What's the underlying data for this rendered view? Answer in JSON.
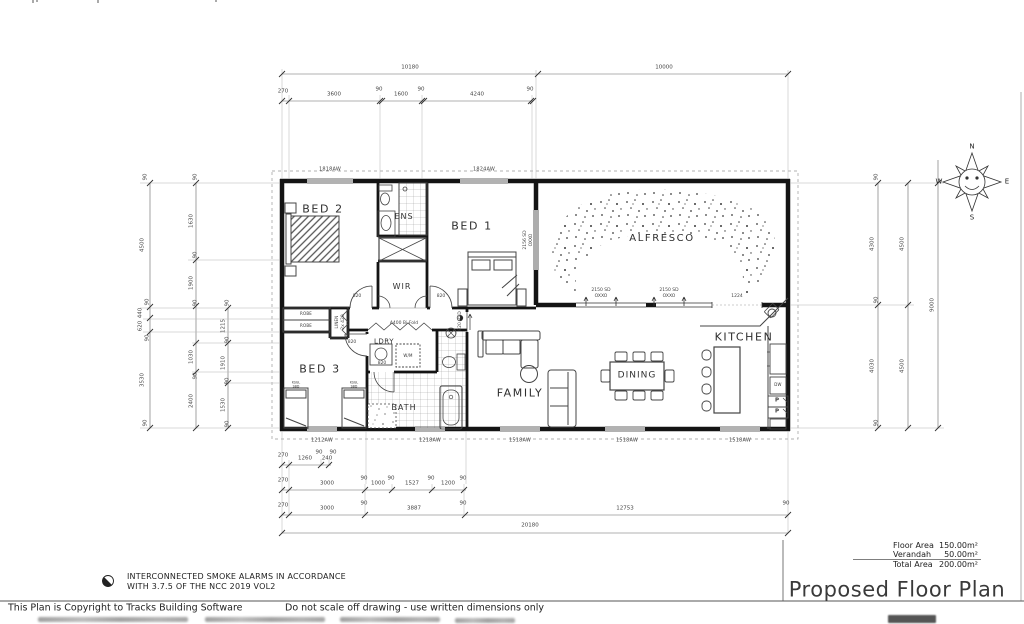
{
  "page": {
    "footer_copyright": "This Plan is Copyright to Tracks Building Software",
    "footer_disclaimer": "Do not scale off drawing - use written dimensions only",
    "note_smoke_1": "INTERCONNECTED SMOKE ALARMS IN ACCORDANCE",
    "note_smoke_2": "WITH 3.7.5 OF THE NCC 2019 VOL2",
    "title": "Proposed Floor Plan"
  },
  "areas": {
    "floor_label": "Floor Area",
    "floor_value": "150.00m²",
    "verandah_label": "Verandah",
    "verandah_value": "50.00m²",
    "total_label": "Total Area",
    "total_value": "200.00m²"
  },
  "compass": {
    "n": "N",
    "e": "E",
    "s": "S",
    "w": "W"
  },
  "rooms": {
    "bed1": "BED 1",
    "bed2": "BED 2",
    "bed3": "BED 3",
    "ens": "ENS",
    "wir": "WIR",
    "alfresco": "ALFRESCO",
    "family": "FAMILY",
    "dining": "DINING",
    "kitchen": "KITCHEN",
    "bath": "BATH",
    "ldry": "LDRY"
  },
  "fixtures": {
    "robe_top": "ROBE",
    "robe_bottom": "ROBE",
    "linen": "LINEN",
    "wm": "W/M",
    "bed3_bed_l1": "KSGL",
    "bed3_bed_l2": "SBD",
    "pantry1": "P",
    "pantry2": "P",
    "dw": "DW",
    "wo": "WO"
  },
  "windows": {
    "top1": "1818AW",
    "top2": "1824AW",
    "bottom1": "1212AW",
    "bottom2": "1218AW",
    "bottom3": "1518AW",
    "bottom4": "1518AW",
    "bottom5": "1518AW"
  },
  "doors": {
    "bed2": "820",
    "bed1": "820",
    "bed3": "820",
    "bath": "820",
    "family_rsd": "820 RSD",
    "linen_bifold": "2x 420",
    "ldry_bifold": "A400 Bi-Fold",
    "sd1_line1": "2150 SD",
    "sd1_line2": "OXXO",
    "sd2_line1": "2150 SD",
    "sd2_line2": "OXXO",
    "sd_side_line1": "2156 SD",
    "sd_side_line2": "OXXO",
    "opening_1224": "1224"
  },
  "dims": {
    "top_overall": [
      "10180",
      "10000"
    ],
    "top_detail": [
      "270",
      "3600",
      "90",
      "1600",
      "90",
      "4240",
      "90"
    ],
    "left_a": [
      "90",
      "4500",
      "90",
      "440",
      "620",
      "90",
      "3530",
      "90"
    ],
    "left_b": [
      "90",
      "1630",
      "90",
      "1900",
      "90",
      "1030",
      "90",
      "2400"
    ],
    "left_c": [
      "90",
      "1215",
      "90",
      "1910",
      "90",
      "1530",
      "90"
    ],
    "right_inner": [
      "90",
      "4300",
      "90",
      "4030",
      "90"
    ],
    "right_mid": [
      "4500",
      "4500"
    ],
    "right_outer": "9000",
    "bottom_r1": [
      "270",
      "1260",
      "90",
      "240",
      "90"
    ],
    "bottom_r2": [
      "270",
      "3000",
      "90",
      "1000",
      "90",
      "1527",
      "90",
      "1200",
      "90"
    ],
    "bottom_r3": [
      "270",
      "3000",
      "90",
      "3887",
      "90",
      "12753",
      "90"
    ],
    "bottom_total": "20180"
  }
}
